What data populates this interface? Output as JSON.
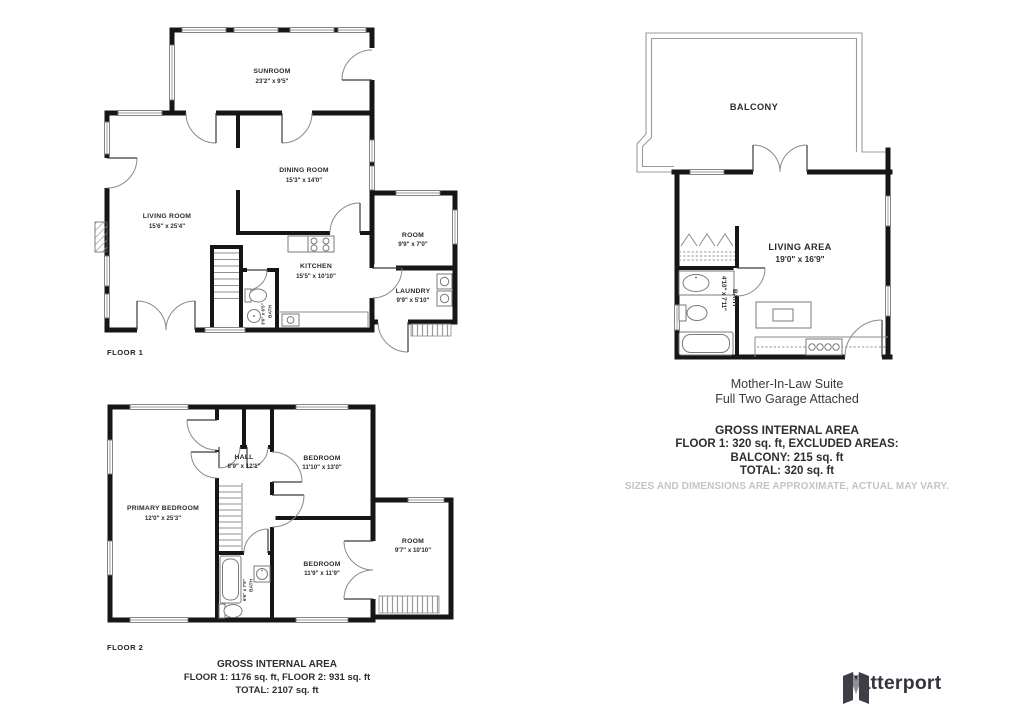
{
  "floor1": {
    "label": "FLOOR 1",
    "rooms": {
      "sunroom": {
        "name": "SUNROOM",
        "dims": "23'2\" x 9'5\""
      },
      "dining_room": {
        "name": "DINING ROOM",
        "dims": "15'3\" x 14'0\""
      },
      "living_room": {
        "name": "LIVING ROOM",
        "dims": "15'6\" x 25'4\""
      },
      "kitchen": {
        "name": "KITCHEN",
        "dims": "15'5\" x 10'10\""
      },
      "room": {
        "name": "ROOM",
        "dims": "9'9\" x 7'0\""
      },
      "laundry": {
        "name": "LAUNDRY",
        "dims": "9'9\" x 5'10\""
      },
      "bath": {
        "name": "BATH",
        "dims": "3'6\" x 6'5\""
      }
    }
  },
  "floor2": {
    "label": "FLOOR 2",
    "rooms": {
      "primary_bedroom": {
        "name": "PRIMARY BEDROOM",
        "dims": "12'0\" x 25'3\""
      },
      "hall": {
        "name": "HALL",
        "dims": "6'9\" x 12'1\""
      },
      "bedroom_top": {
        "name": "BEDROOM",
        "dims": "11'10\" x 13'0\""
      },
      "bedroom_bottom": {
        "name": "BEDROOM",
        "dims": "11'9\" x 11'9\""
      },
      "room": {
        "name": "ROOM",
        "dims": "9'7\" x 10'10\""
      },
      "bath": {
        "name": "BATH",
        "dims": "6'6\" x 7'9\""
      }
    }
  },
  "house_area_summary": {
    "heading": "GROSS INTERNAL AREA",
    "line1": "FLOOR 1: 1176 sq. ft, FLOOR 2: 931 sq. ft",
    "line2": "TOTAL: 2107 sq. ft"
  },
  "suite": {
    "title": "Mother-In-Law Suite",
    "subtitle": "Full Two Garage Attached",
    "rooms": {
      "balcony": {
        "name": "BALCONY"
      },
      "living_area": {
        "name": "LIVING AREA",
        "dims": "19'0\" x 16'9\""
      },
      "bath": {
        "name": "BATH",
        "dims": "4'10\" x 7'11\""
      }
    },
    "area_summary": {
      "heading": "GROSS INTERNAL AREA",
      "line1": "FLOOR 1: 320 sq. ft, EXCLUDED AREAS:",
      "line2": "BALCONY: 215 sq. ft",
      "line3": "TOTAL: 320 sq. ft",
      "disclaimer": "SIZES AND DIMENSIONS ARE APPROXIMATE, ACTUAL MAY VARY."
    }
  },
  "branding": {
    "name": "Matterport"
  },
  "colors": {
    "wall": "#161616",
    "logo_dark": "#3e3e46",
    "logo_gray": "#8f8f97",
    "disclaimer_gray": "#c4c4c4"
  }
}
